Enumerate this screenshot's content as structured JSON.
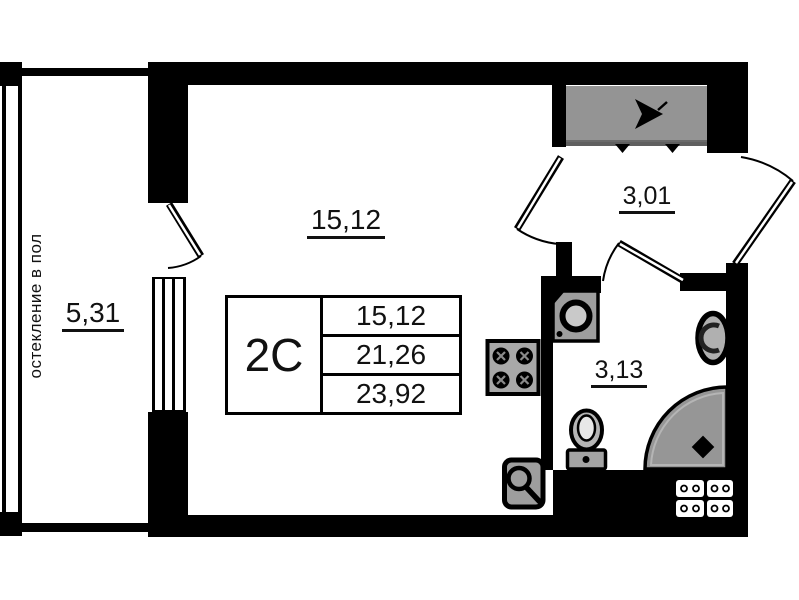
{
  "unit": {
    "type_code": "2С",
    "area_rows": {
      "living": "15,12",
      "total": "21,26",
      "total_with_balcony": "23,92"
    }
  },
  "rooms": {
    "living": {
      "area": "15,12"
    },
    "balcony": {
      "area": "5,31",
      "glazing_note": "остекление в пол"
    },
    "hall": {
      "area": "3,01"
    },
    "bathroom": {
      "area": "3,13"
    }
  },
  "colors": {
    "wall": "#000000",
    "entry_shaft_gray": "#949494",
    "fixture_gray": "#9e9e9e",
    "shower_gray": "#969696"
  }
}
